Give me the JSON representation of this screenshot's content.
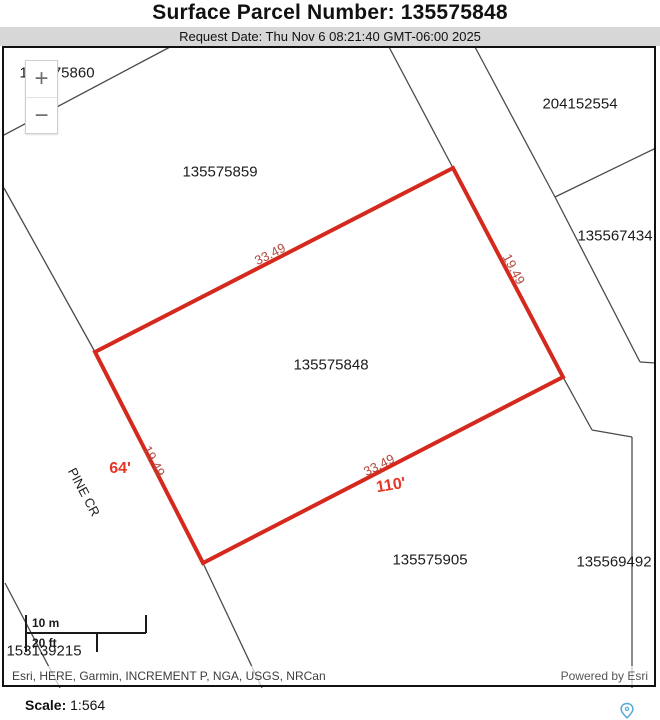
{
  "header": {
    "title": "Surface Parcel Number: 135575848",
    "request_date": "Request Date: Thu Nov 6 08:21:40 GMT-06:00 2025"
  },
  "zoom_control": {
    "zoom_in": "+",
    "zoom_out": "−"
  },
  "map": {
    "colors": {
      "background": "#ffffff",
      "boundary_line": "#4b4b4b",
      "parcel_outline": "#d5291e",
      "dim_measurement": "#b14a40",
      "bright_measurement": "#e63526",
      "pin_blue": "#57a8d7"
    },
    "parcel_labels": [
      {
        "text": "135575860",
        "x": 57,
        "y": 73
      },
      {
        "text": "204152554",
        "x": 580,
        "y": 104
      },
      {
        "text": "135575859",
        "x": 220,
        "y": 172
      },
      {
        "text": "135567434",
        "x": 615,
        "y": 236
      },
      {
        "text": "135575848",
        "x": 331,
        "y": 365
      },
      {
        "text": "135575905",
        "x": 430,
        "y": 560
      },
      {
        "text": "135569492",
        "x": 614,
        "y": 562
      },
      {
        "text": "153139215",
        "x": 44,
        "y": 651
      }
    ],
    "street_label": {
      "text": "PINE CR",
      "x": 84,
      "y": 492,
      "angle": 62
    },
    "measurements": [
      {
        "text": "33.49",
        "x": 270,
        "y": 254,
        "angle": -27,
        "style": "dim"
      },
      {
        "text": "19.49",
        "x": 514,
        "y": 269,
        "angle": 62,
        "style": "dim"
      },
      {
        "text": "19.49",
        "x": 154,
        "y": 461,
        "angle": 62,
        "style": "dim"
      },
      {
        "text": "33.49",
        "x": 379,
        "y": 465,
        "angle": -27,
        "style": "dim"
      },
      {
        "text": "64'",
        "x": 120,
        "y": 469,
        "angle": 0,
        "style": "bright"
      },
      {
        "text": "110'",
        "x": 391,
        "y": 486,
        "angle": -9,
        "style": "bright"
      }
    ],
    "subject_parcel_outline_points": "95,352 453,168 563,377 203,563",
    "boundary_lines": [
      [
        4,
        135,
        170,
        47
      ],
      [
        4,
        188,
        95,
        352
      ],
      [
        203,
        563,
        262,
        688
      ],
      [
        389,
        47,
        453,
        168
      ],
      [
        563,
        377,
        592,
        430
      ],
      [
        592,
        430,
        632,
        437
      ],
      [
        632,
        437,
        632,
        688
      ],
      [
        475,
        47,
        555,
        197
      ],
      [
        555,
        197,
        640,
        362
      ],
      [
        640,
        362,
        656,
        363
      ],
      [
        555,
        197,
        656,
        148
      ],
      [
        5,
        583,
        60,
        688
      ]
    ],
    "scale_bar": {
      "meters_label": "10 m",
      "feet_label": "20 ft"
    },
    "attribution": "Esri, HERE, Garmin, INCREMENT P, NGA, USGS, NRCan",
    "powered_by": "Powered by Esri"
  },
  "footer": {
    "scale_label": "Scale:",
    "scale_value": "1:564"
  }
}
